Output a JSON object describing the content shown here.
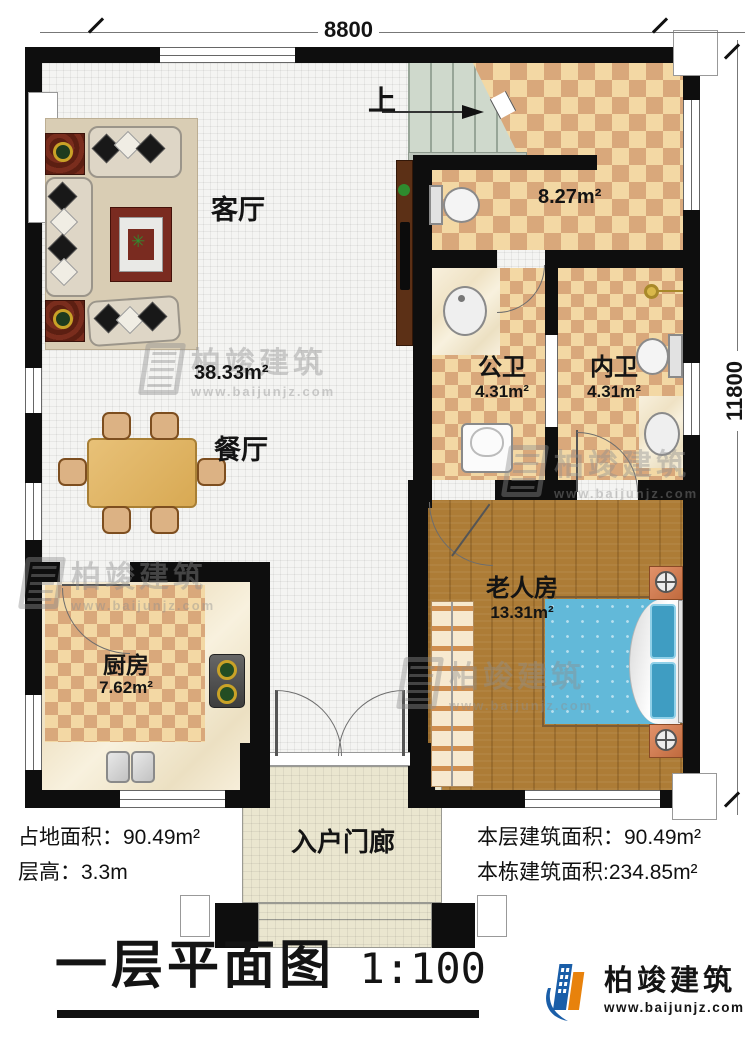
{
  "dims": {
    "top": "8800",
    "right": "11800"
  },
  "rooms": {
    "living": {
      "name": "客厅",
      "area": "38.33m²"
    },
    "dining": {
      "name": "餐厅"
    },
    "kitchen": {
      "name": "厨房",
      "area": "7.62m²"
    },
    "stair_hall": {
      "area": "8.27m²",
      "up": "上"
    },
    "public_bath": {
      "name": "公卫",
      "area": "4.31m²"
    },
    "ensuite_bath": {
      "name": "内卫",
      "area": "4.31m²"
    },
    "elder_bedroom": {
      "name": "老人房",
      "area": "13.31m²"
    },
    "porch": {
      "name": "入户门廊"
    }
  },
  "stats": {
    "site_area": "占地面积：90.49m²",
    "floor_height": "层高：3.3m",
    "floor_area": "本层建筑面积：90.49m²",
    "total_area": "本栋建筑面积:234.85m²"
  },
  "title": {
    "text": "一层平面图",
    "scale": "1:100"
  },
  "brand": {
    "name": "柏竣建筑",
    "site": "www.baijunjz.com"
  },
  "colors": {
    "wall": "#0e0e0e",
    "checker_light": "#f3d8a4",
    "checker_dark": "#d9a87b",
    "wood": "#ad7c36",
    "stair": "#cfd9cc",
    "porch": "#eae6cf",
    "bed": "#62b9d9",
    "brand_blue": "#1a5ea8",
    "brand_orange": "#e8820c"
  }
}
